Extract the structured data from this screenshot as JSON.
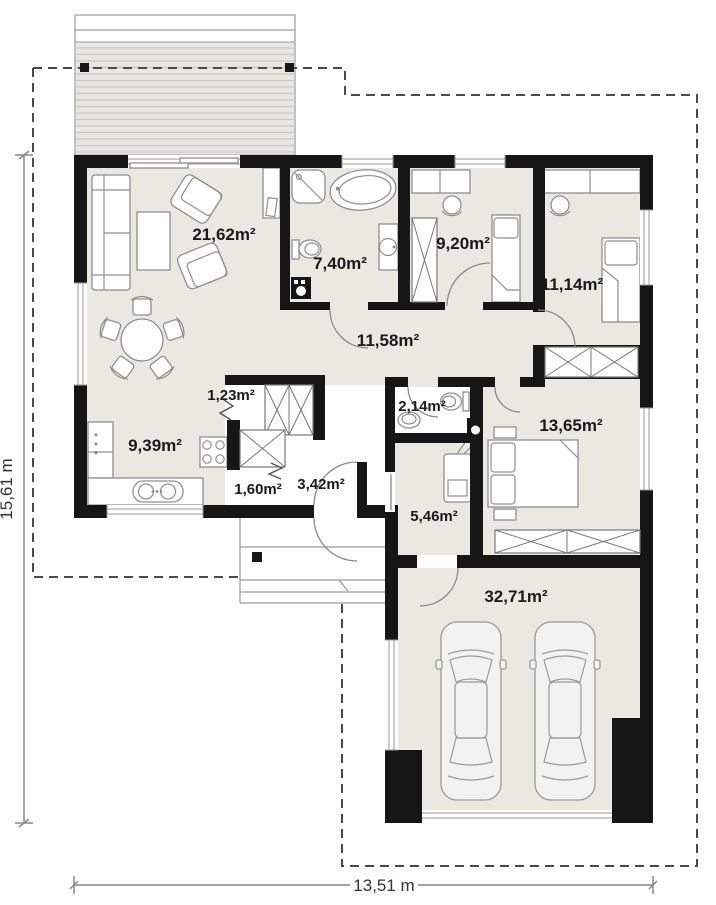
{
  "plan": {
    "rooms": [
      {
        "id": "living-room",
        "area": "21,62m²"
      },
      {
        "id": "bathroom",
        "area": "7,40m²"
      },
      {
        "id": "kids-room",
        "area": "9,20m²"
      },
      {
        "id": "bedroom-small",
        "area": "11,14m²"
      },
      {
        "id": "hall",
        "area": "11,58m²"
      },
      {
        "id": "closet",
        "area": "1,23m²"
      },
      {
        "id": "wc",
        "area": "2,14m²"
      },
      {
        "id": "kitchen",
        "area": "9,39m²"
      },
      {
        "id": "bedroom-main",
        "area": "13,65m²"
      },
      {
        "id": "pantry",
        "area": "1,60m²"
      },
      {
        "id": "corridor",
        "area": "3,42m²"
      },
      {
        "id": "utility-room",
        "area": "5,46m²"
      },
      {
        "id": "garage",
        "area": "32,71m²"
      }
    ],
    "dimensions": {
      "height": "15,61 m",
      "width": "13,51 m"
    },
    "colors": {
      "wall": "#161616",
      "floor": "#e9e8e1",
      "floor_light": "#ffffff",
      "furniture_line": "#8f8f8f",
      "boundary_dash": "#4a4a4a",
      "label": "#1a1a1a"
    }
  }
}
